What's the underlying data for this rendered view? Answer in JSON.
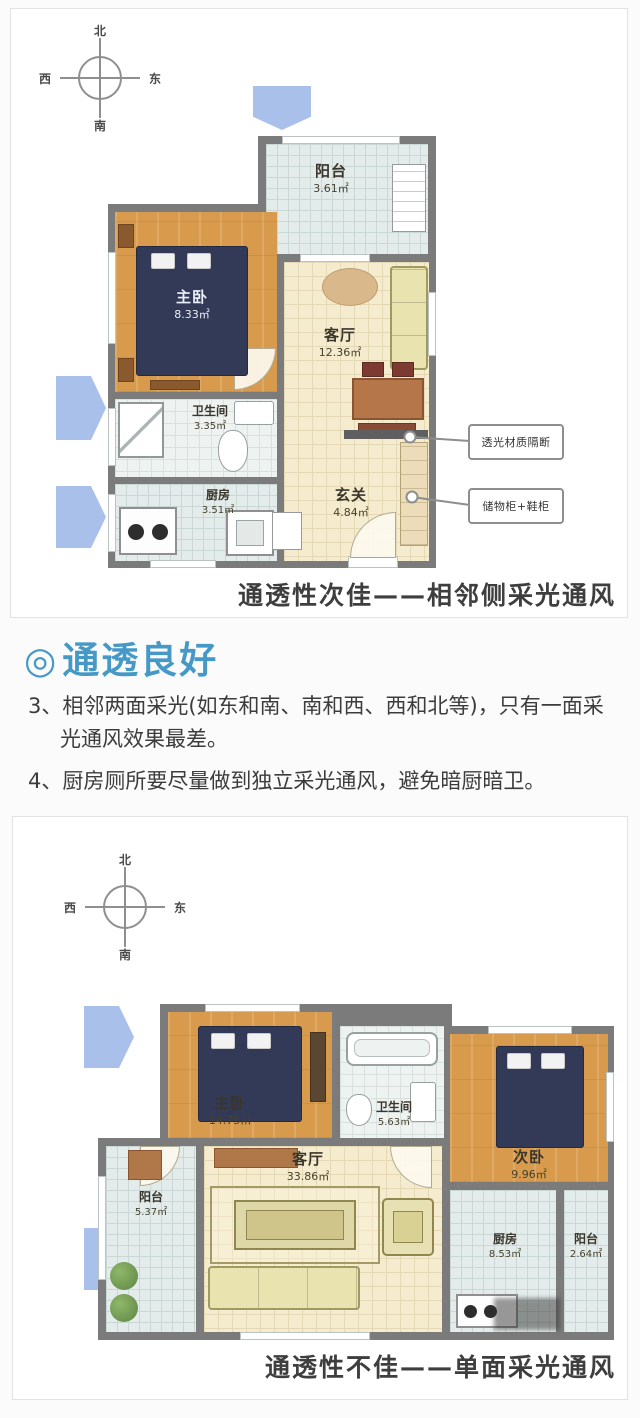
{
  "plan1": {
    "compass": {
      "n": "北",
      "s": "南",
      "e": "东",
      "w": "西"
    },
    "rooms": {
      "balcony": {
        "name": "阳台",
        "area": "3.61㎡"
      },
      "master": {
        "name": "主卧",
        "area": "8.33㎡"
      },
      "living": {
        "name": "客厅",
        "area": "12.36㎡"
      },
      "bath": {
        "name": "卫生间",
        "area": "3.35㎡"
      },
      "kitchen": {
        "name": "厨房",
        "area": "3.51㎡"
      },
      "foyer": {
        "name": "玄关",
        "area": "4.84㎡"
      }
    },
    "callouts": {
      "partition": "透光材质隔断",
      "cabinet": "储物柜+鞋柜"
    },
    "caption": "通透性次佳——相邻侧采光通风"
  },
  "note": {
    "marker": "◎",
    "title": "通透良好",
    "point3": "3、相邻两面采光(如东和南、南和西、西和北等)，只有一面采光通风效果最差。",
    "point4": "4、厨房厕所要尽量做到独立采光通风，避免暗厨暗卫。"
  },
  "plan2": {
    "compass": {
      "n": "北",
      "s": "南",
      "e": "东",
      "w": "西"
    },
    "rooms": {
      "master": {
        "name": "主卧",
        "area": "14.75㎡"
      },
      "bath": {
        "name": "卫生间",
        "area": "5.63㎡"
      },
      "second": {
        "name": "次卧",
        "area": "9.96㎡"
      },
      "living": {
        "name": "客厅",
        "area": "33.86㎡"
      },
      "balcony_left": {
        "name": "阳台",
        "area": "5.37㎡"
      },
      "kitchen": {
        "name": "厨房",
        "area": "8.53㎡"
      },
      "balcony_right": {
        "name": "阳台",
        "area": "2.64㎡"
      }
    },
    "caption": "通透性不佳——单面采光通风"
  },
  "colors": {
    "accent_blue": "#4699c6",
    "arrow_blue": "#a9c0ea",
    "wall_gray": "#7b7b7b"
  }
}
